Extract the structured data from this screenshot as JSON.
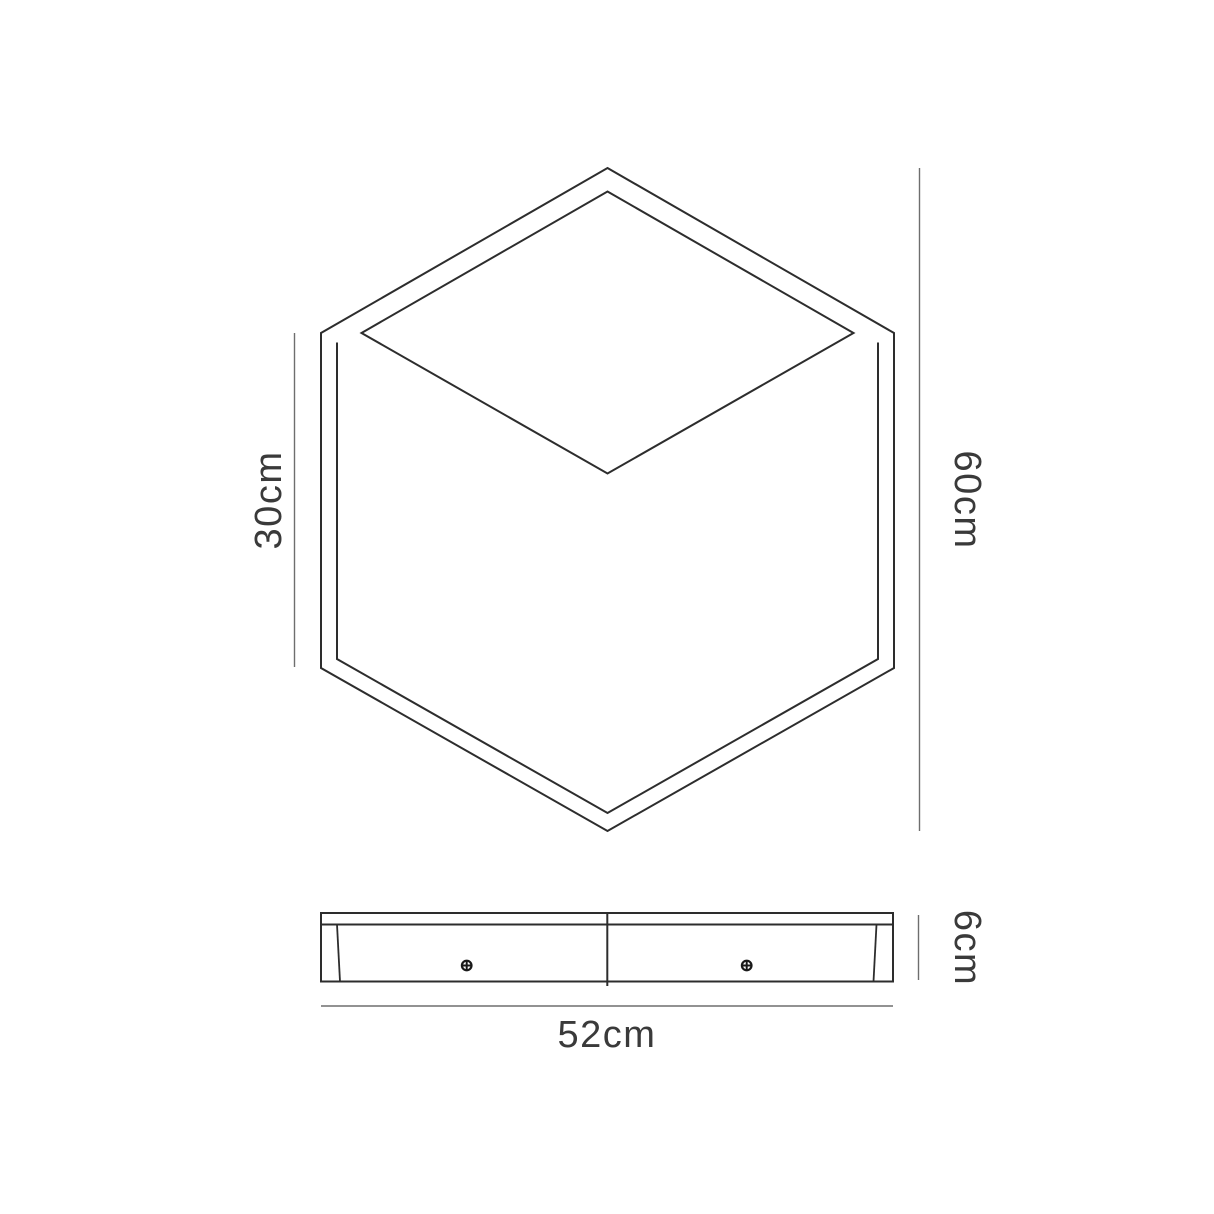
{
  "diagram": {
    "type": "product-dimension-line-drawing",
    "views": {
      "front": {
        "description": "isometric cube outline (hexagon with inner top-face frame and front-face frame)"
      },
      "side": {
        "description": "thin side profile bar with two screws and center divider"
      }
    },
    "dimensions": {
      "left_height": "30cm",
      "right_height": "60cm",
      "side_thickness": "6cm",
      "width": "52cm"
    },
    "colors": {
      "line": "#2d2d2d",
      "dimension_line": "#6e6e6e",
      "text": "#3a3a3a",
      "background": "#ffffff"
    }
  }
}
